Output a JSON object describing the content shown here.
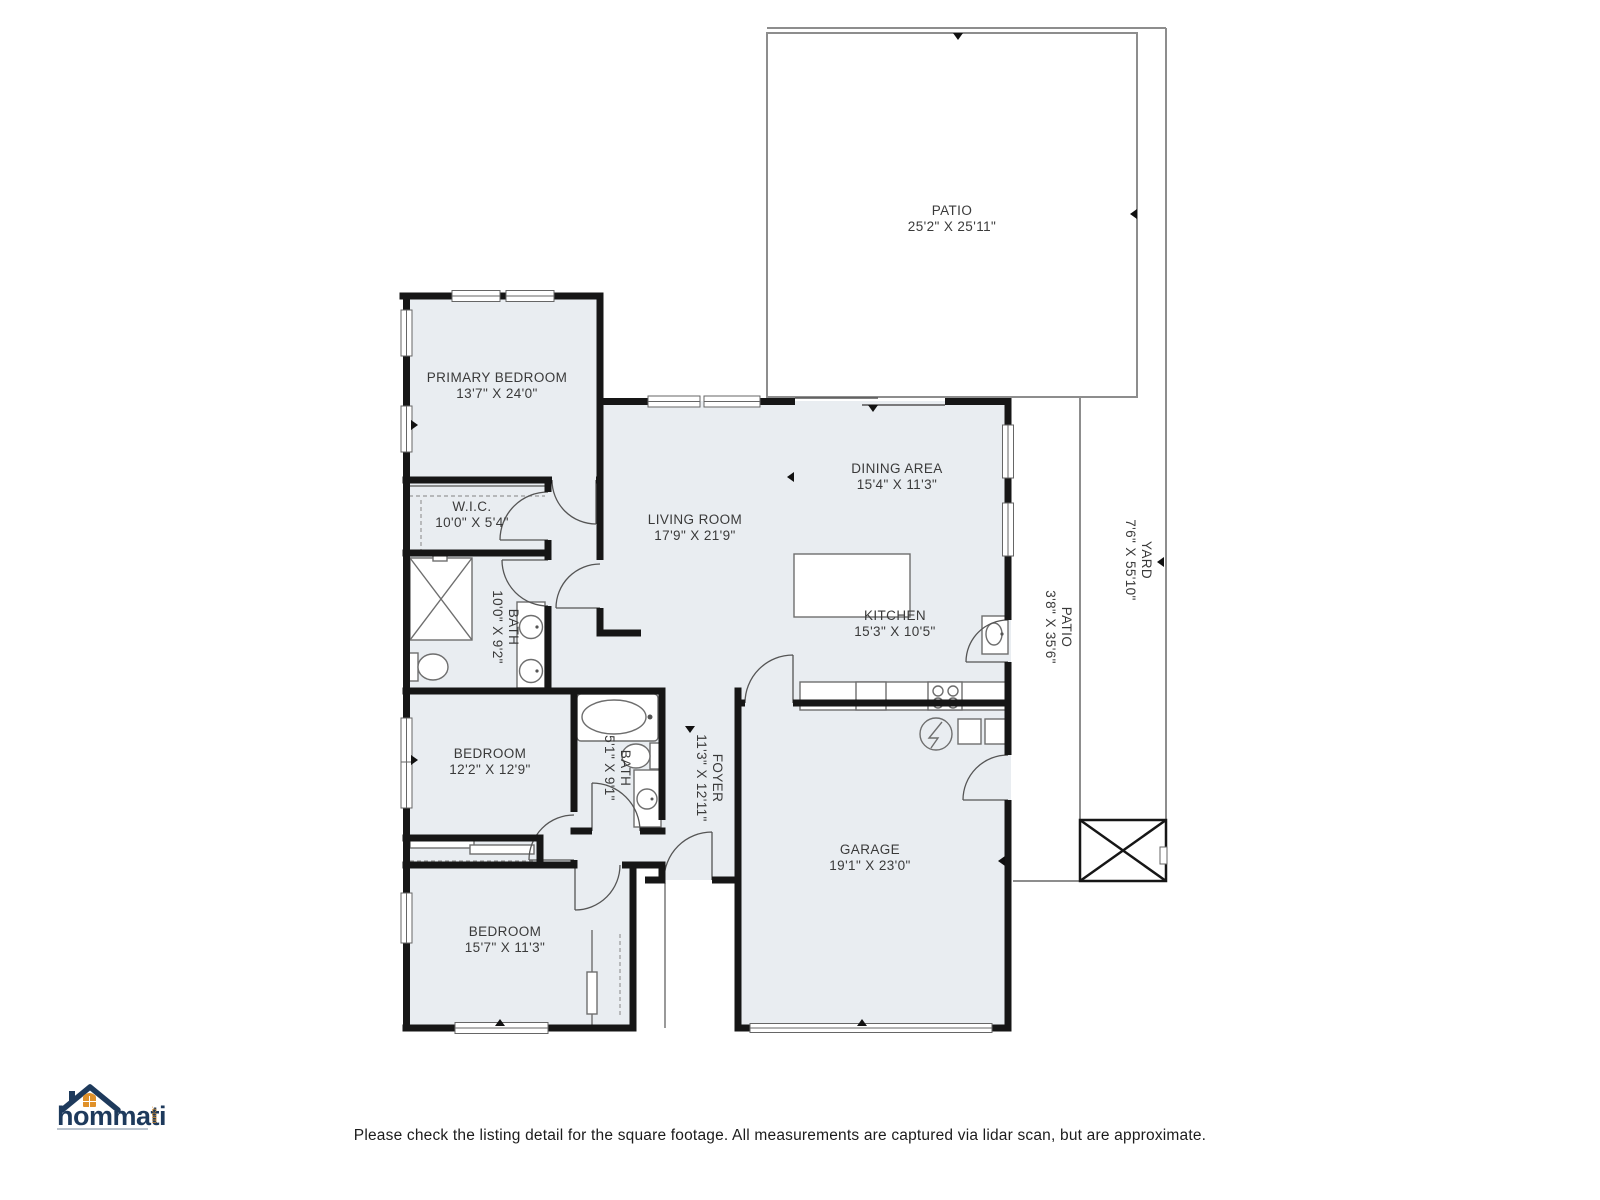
{
  "footer": {
    "disclaimer": "Please check the listing detail for the square footage. All measurements are captured via lidar scan, but are approximate."
  },
  "logo": {
    "brand": "hommati",
    "suffix": ".com"
  },
  "colors": {
    "room_fill": "#e9edf1",
    "wall": "#161616",
    "outdoor_outline": "#8d8d8d",
    "label_text": "#3a3a3a",
    "logo_navy": "#1e3a5c",
    "logo_orange": "#e0912a"
  },
  "rooms": {
    "patio_top": {
      "name": "PATIO",
      "dims": "25'2\" X 25'11\""
    },
    "yard": {
      "name": "YARD",
      "dims": "7'6\" X 55'10\""
    },
    "patio_side": {
      "name": "PATIO",
      "dims": "3'8\" X 35'6\""
    },
    "primary_bedroom": {
      "name": "PRIMARY BEDROOM",
      "dims": "13'7\" X 24'0\""
    },
    "wic": {
      "name": "W.I.C.",
      "dims": "10'0\" X 5'4\""
    },
    "primary_bath": {
      "name": "BATH",
      "dims": "10'0\" X 9'2\""
    },
    "living_room": {
      "name": "LIVING ROOM",
      "dims": "17'9\" X 21'9\""
    },
    "dining_area": {
      "name": "DINING AREA",
      "dims": "15'4\" X 11'3\""
    },
    "kitchen": {
      "name": "KITCHEN",
      "dims": "15'3\" X 10'5\""
    },
    "bedroom_2": {
      "name": "BEDROOM",
      "dims": "12'2\" X 12'9\""
    },
    "bath_2": {
      "name": "BATH",
      "dims": "5'1\" X 9'1\""
    },
    "foyer": {
      "name": "FOYER",
      "dims": "11'3\" X 12'11\""
    },
    "garage": {
      "name": "GARAGE",
      "dims": "19'1\" X 23'0\""
    },
    "bedroom_3": {
      "name": "BEDROOM",
      "dims": "15'7\" X 11'3\""
    }
  }
}
